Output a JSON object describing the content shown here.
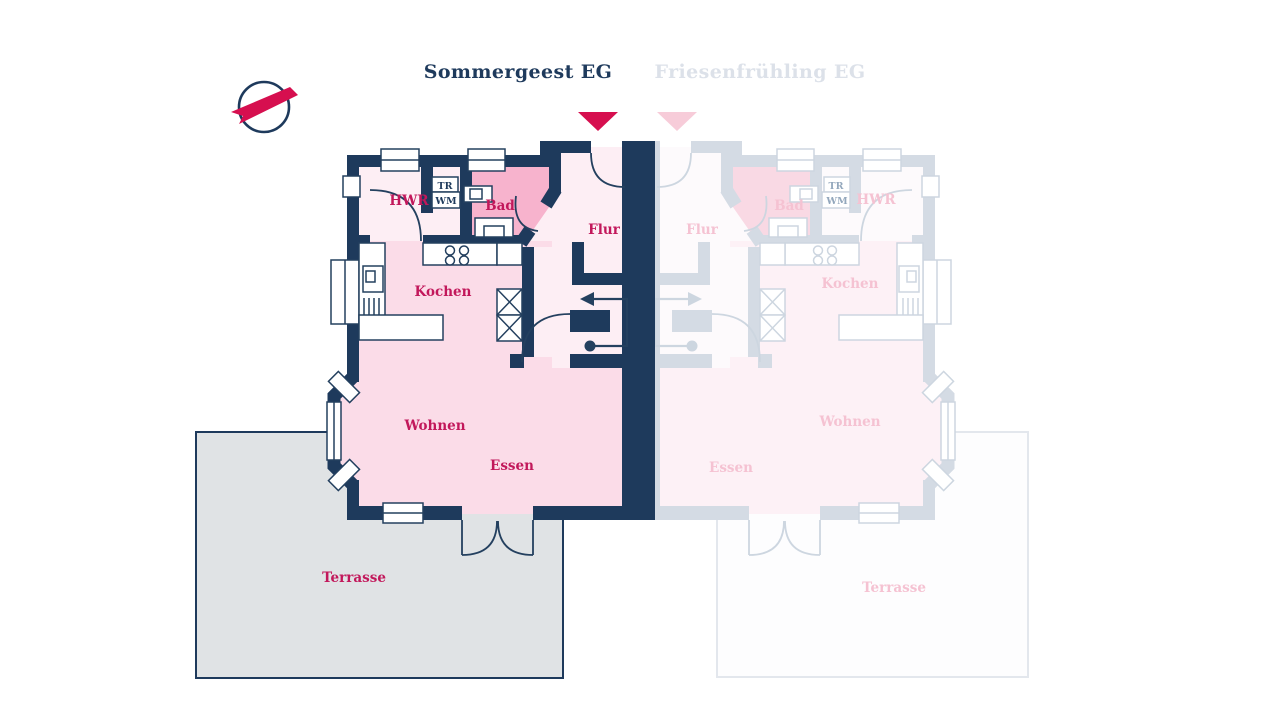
{
  "header": {
    "tabs": [
      {
        "id": "sommergeest",
        "label": "Sommergeest EG",
        "active": true
      },
      {
        "id": "friesenfruehling",
        "label": "Friesenfrühling EG",
        "active": false
      }
    ]
  },
  "logo": {
    "name": "builder-ribbon-logo"
  },
  "plans": {
    "sommergeest": {
      "tab": "Sommergeest EG",
      "rooms": {
        "hwr": "HWR",
        "bad": "Bad",
        "flur": "Flur",
        "kochen": "Kochen",
        "wohnen": "Wohnen",
        "essen": "Essen",
        "terrasse": "Terrasse"
      },
      "appliances": {
        "tr": "TR",
        "wm": "WM"
      }
    },
    "friesenfruehling": {
      "tab": "Friesenfrühling EG",
      "rooms": {
        "hwr": "HWR",
        "bad": "Bad",
        "flur": "Flur",
        "kochen": "Kochen",
        "wohnen": "Wohnen",
        "essen": "Essen",
        "terrasse": "Terrasse"
      },
      "appliances": {
        "tr": "TR",
        "wm": "WM"
      }
    }
  },
  "colors": {
    "navy": "#1e3a5c",
    "crimson": "#c2185b",
    "marker": "#d60f4f",
    "badPink": "#f7b3cd",
    "roomPink": "#fbdce8",
    "roomLight": "#fdeef4",
    "terraceFill": "#e0e3e5",
    "inactiveTab": "#dce1e9",
    "fadedWall": "#d4dbe4",
    "fadedRoomPink": "#fdf1f6",
    "fadedRoomLight": "#fdfafc",
    "fadedBad": "#f9d9e4",
    "fadedLabel": "#f5c2d2",
    "fadedAppl": "#93a7bc",
    "fadedMarker": "#f7ccd9",
    "fadedTerraceFill": "#fdfdfe",
    "fadedTerraceBorder": "#e3e7ed"
  }
}
